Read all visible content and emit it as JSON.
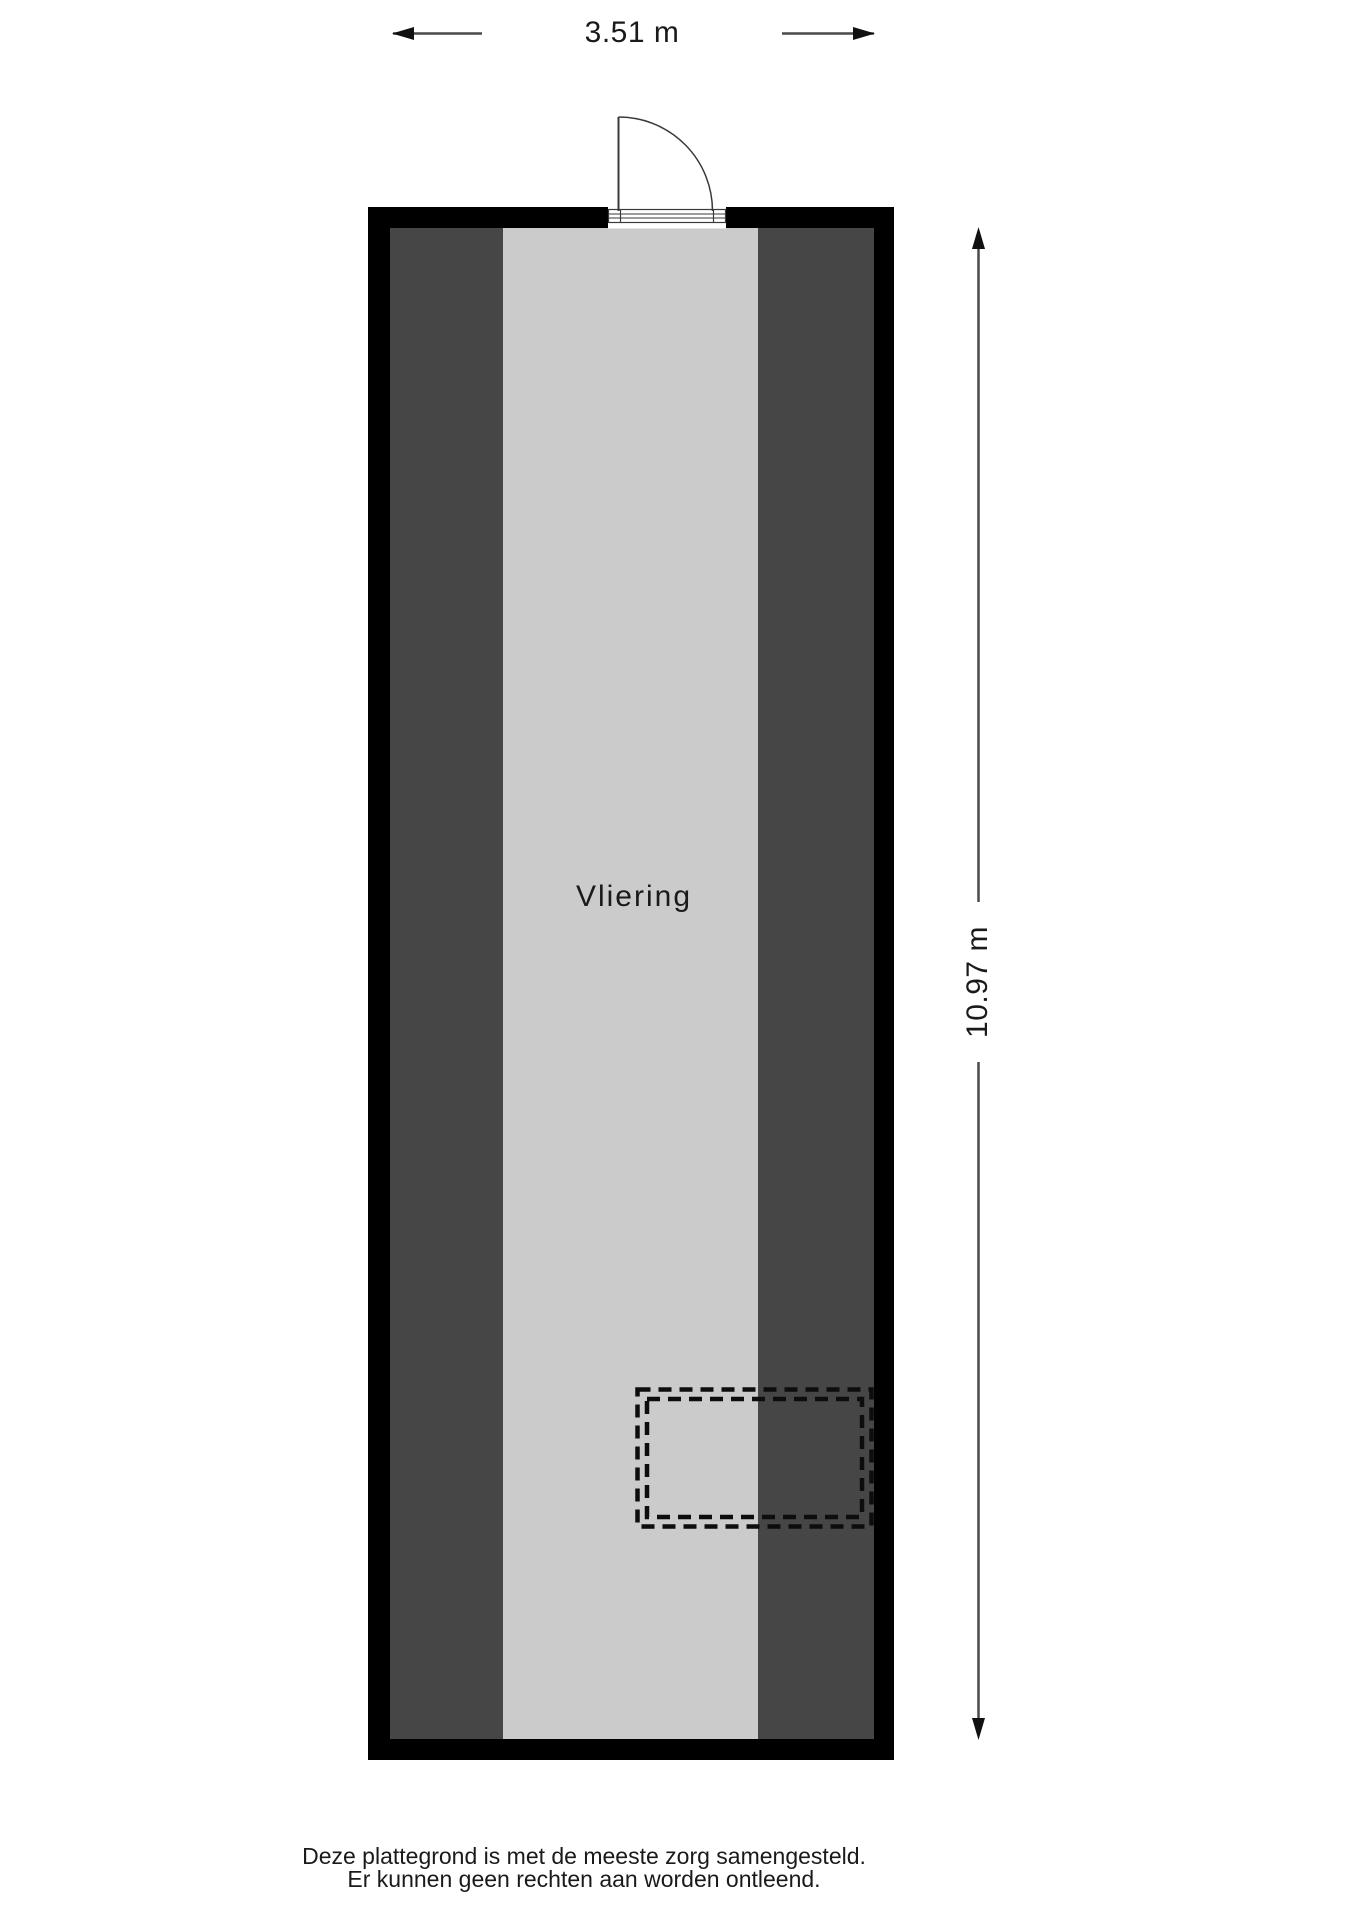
{
  "plan": {
    "room_label": "Vliering",
    "width_dimension": "3.51 m",
    "height_dimension": "10.97 m"
  },
  "disclaimer": {
    "line1": "Deze plattegrond is met de meeste zorg samengesteld.",
    "line2": "Er kunnen geen rechten aan worden ontleend."
  },
  "colors": {
    "wall": "#000000",
    "roof_slope": "#464646",
    "floor": "#cbcbcb",
    "line": "#4a4a4a",
    "arrow": "#111111",
    "dashed": "#0d0d0d",
    "door_stroke": "#3a3a3a",
    "text": "#1a1a1a"
  }
}
